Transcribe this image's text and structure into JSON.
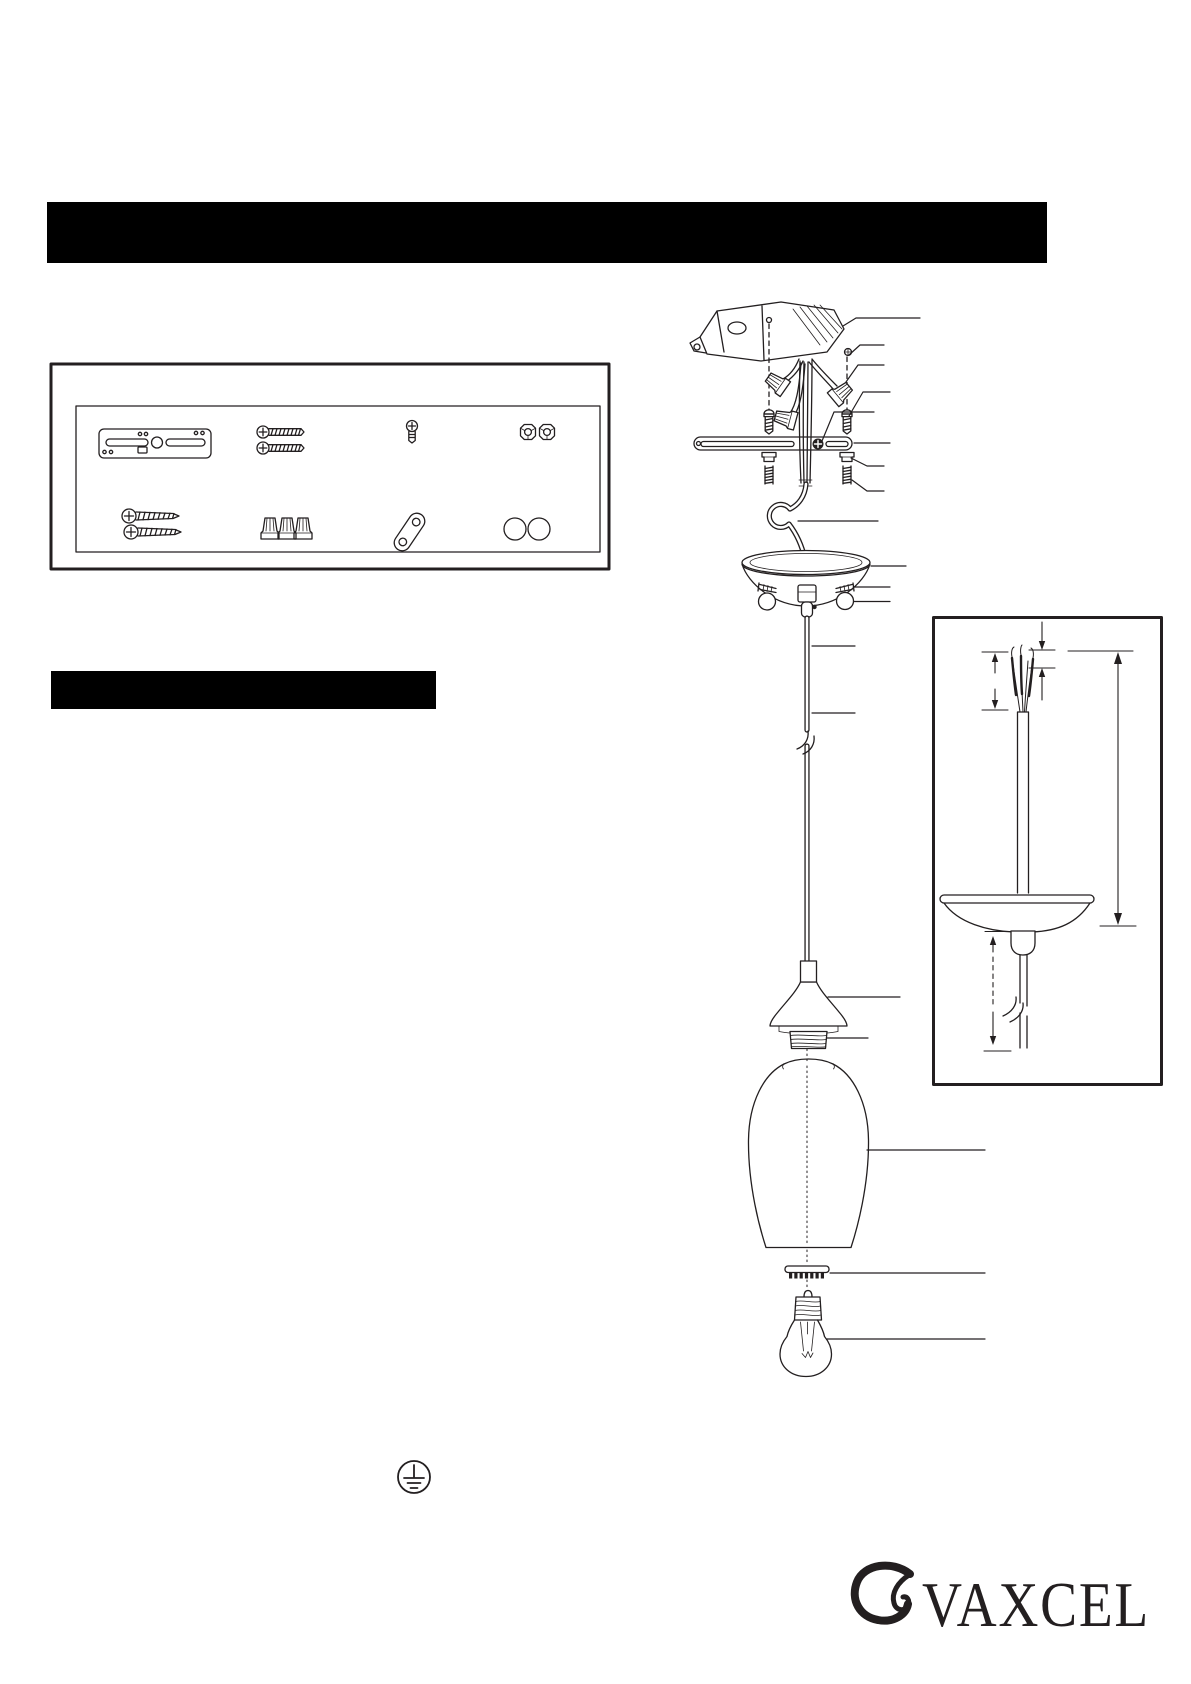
{
  "page": {
    "width": 1191,
    "height": 1684,
    "background": "#ffffff",
    "ink": "#231f20"
  },
  "redacted_bars": {
    "title_bar": {
      "color": "#000000",
      "text": ""
    },
    "section_bar": {
      "color": "#000000",
      "text": ""
    }
  },
  "package_contents_box": {
    "items": [
      "mounting-strap",
      "machine-screws",
      "ground-screw",
      "hex-cap-nuts",
      "wood-screws",
      "wire-nuts",
      "ground-link",
      "finial-balls"
    ]
  },
  "installation_diagram": {
    "parts": [
      "outlet-box",
      "mounting-screw-left",
      "mounting-screw-right",
      "wire-nut-a",
      "wire-nut-b",
      "wire-nut-c",
      "crossbar",
      "ground-screw",
      "hex-cap-nuts",
      "threaded-nipples",
      "cord-loop",
      "canopy",
      "side-set-screws",
      "finial-balls",
      "cord-grip",
      "cord",
      "socket-holder",
      "threaded-socket",
      "glass-shade",
      "socket-ring",
      "light-bulb"
    ],
    "leader_lines_count": 19
  },
  "wiring_detail_inset": {
    "elements": [
      "stripped-wire-strands",
      "cord-jacket",
      "strip-length-dimension",
      "jacket-strip-dimension",
      "overall-length-dimension",
      "canopy",
      "cord-grip",
      "cord-break",
      "below-canopy-dimension"
    ]
  },
  "symbols": {
    "ground_symbol": "protective-earth-ground"
  },
  "footer": {
    "brand": "VAXCEL"
  }
}
